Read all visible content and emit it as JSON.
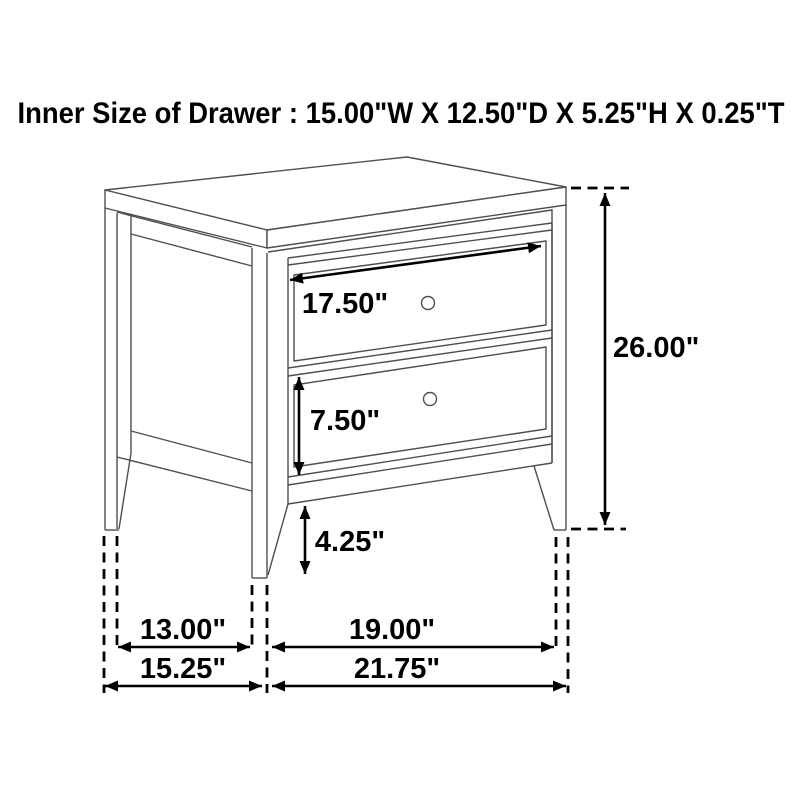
{
  "title": "Inner Size of Drawer : 15.00\"W X 12.50\"D X 5.25\"H X 0.25\"T",
  "inner_drawer_size": {
    "width": "15.00\"W",
    "depth": "12.50\"D",
    "height": "5.25\"H",
    "thickness": "0.25\"T"
  },
  "dimensions": {
    "drawer_width": "17.50\"",
    "overall_height": "26.00\"",
    "drawer_face_height": "7.50\"",
    "leg_height": "4.25\"",
    "side_inner_span": "13.00\"",
    "front_inner_span": "19.00\"",
    "side_overall_depth": "15.25\"",
    "front_overall_width": "21.75\""
  },
  "colors": {
    "background": "#ffffff",
    "furniture_line": "#4f4f4f",
    "dimension_line": "#000000",
    "text": "#000000"
  }
}
